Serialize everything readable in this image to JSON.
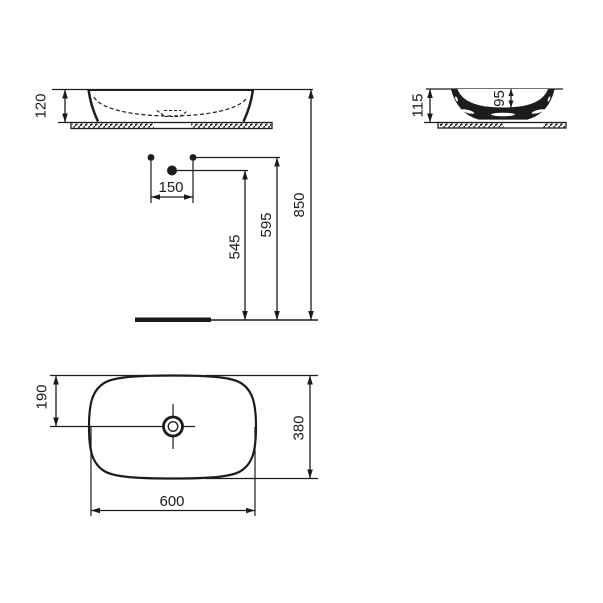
{
  "drawing": {
    "type": "technical-dimension-drawing",
    "subject": "oval countertop vessel washbasin",
    "line_color": "#1c1c1c",
    "background": "#ffffff",
    "views": {
      "front": {
        "name": "front elevation",
        "basin_height_mm": "120"
      },
      "side": {
        "name": "side section",
        "total_height_mm": "115",
        "bowl_depth_mm": "95"
      },
      "installation": {
        "name": "installation dimensions",
        "hole_spacing_mm": "150",
        "drain_height_mm": "545",
        "supply_height_mm": "595",
        "rim_height_mm": "850"
      },
      "plan": {
        "name": "plan view",
        "center_offset_mm": "190",
        "basin_depth_mm": "380",
        "basin_width_mm": "600"
      }
    }
  }
}
